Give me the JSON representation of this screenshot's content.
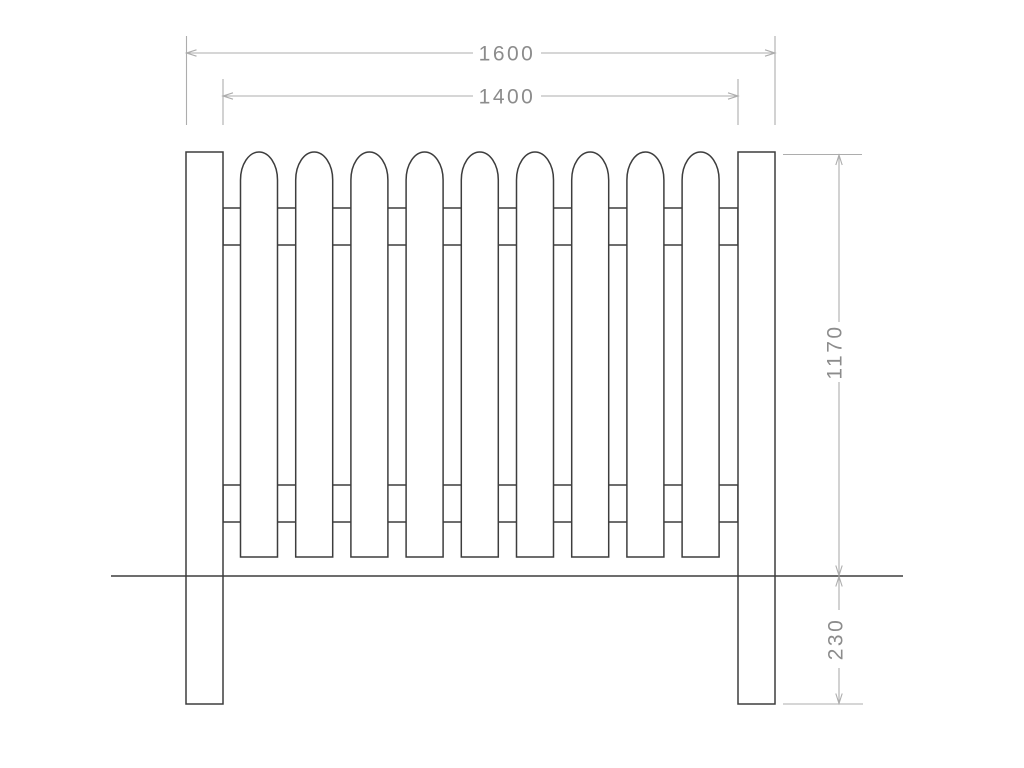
{
  "drawing": {
    "description": "Technical elevation drawing of a picket fence panel with two posts, two horizontal rails, round-top pales and a ground line",
    "colors": {
      "outline": "#3d3d3d",
      "dimension_lines": "#adadad",
      "dimension_text": "#8c8c8c",
      "fill": "#ffffff",
      "background": "#ffffff"
    },
    "fence": {
      "picket_count": 9,
      "post_count": 2,
      "rail_count": 2
    },
    "dimensions": {
      "overall_width": "1600",
      "opening_width": "1400",
      "height_above_ground": "1170",
      "depth_below_ground": "230"
    }
  }
}
